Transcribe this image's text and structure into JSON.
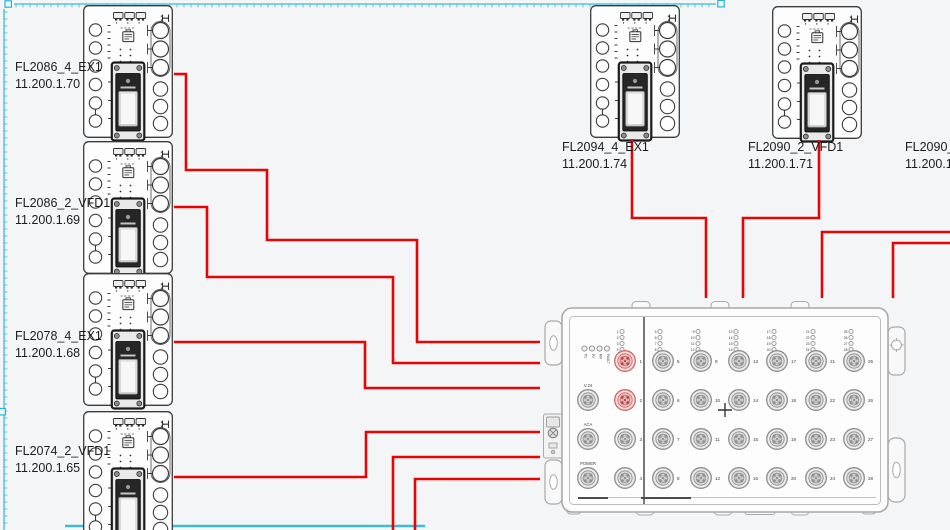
{
  "app": {
    "type": "network-topology-canvas"
  },
  "colors": {
    "background": "#f4f5f6",
    "connection": "#e60505",
    "guide": "#3bbdd8",
    "handle_fill": "#eafbfe",
    "device_stroke": "#3b3b3b",
    "switch_stroke": "#a6a6a6",
    "port_active_ring": "#cc6666",
    "port_idle_ring": "#8d8d8d",
    "label_text": "#1d1d1d"
  },
  "devices": {
    "left": [
      {
        "name": "FL2086_4_EX1",
        "ip": "11.200.1.70"
      },
      {
        "name": "FL2086_2_VFD1",
        "ip": "11.200.1.69"
      },
      {
        "name": "FL2078_4_EX1",
        "ip": "11.200.1.68"
      },
      {
        "name": "FL2074_2_VFD1",
        "ip": "11.200.1.65"
      }
    ],
    "top": [
      {
        "name": "FL2094_4_EX1",
        "ip": "11.200.1.74"
      },
      {
        "name": "FL2090_2_VFD1",
        "ip": "11.200.1.71"
      },
      {
        "name": "FL2090_4",
        "ip": "11.200.1."
      }
    ]
  },
  "switch": {
    "status_leds": [
      "P1",
      "P2",
      "RM",
      "FAULT"
    ],
    "aux_ports": [
      "V.24",
      "ACA",
      "POWER"
    ],
    "left_ports": [
      1,
      2,
      3,
      4
    ],
    "port_columns": [
      [
        5,
        6,
        7,
        8
      ],
      [
        9,
        10,
        11,
        12
      ],
      [
        13,
        14,
        15,
        16
      ],
      [
        17,
        18,
        19,
        20
      ],
      [
        21,
        22,
        23,
        24
      ],
      [
        25,
        26,
        27,
        28
      ]
    ],
    "active_ports": [
      1,
      2
    ]
  },
  "connections": [
    {
      "points": [
        [
          174,
          74
        ],
        [
          186,
          74
        ],
        [
          186,
          170
        ],
        [
          267,
          170
        ],
        [
          267,
          240
        ],
        [
          417,
          240
        ],
        [
          417,
          342
        ],
        [
          540,
          342
        ]
      ]
    },
    {
      "points": [
        [
          174,
          207
        ],
        [
          207,
          207
        ],
        [
          207,
          277
        ],
        [
          393,
          277
        ],
        [
          393,
          363
        ],
        [
          540,
          363
        ]
      ]
    },
    {
      "points": [
        [
          174,
          342
        ],
        [
          365,
          342
        ],
        [
          365,
          388
        ],
        [
          540,
          388
        ]
      ]
    },
    {
      "points": [
        [
          174,
          477
        ],
        [
          366,
          477
        ],
        [
          366,
          432
        ],
        [
          540,
          432
        ]
      ]
    },
    {
      "points": [
        [
          393,
          531
        ],
        [
          393,
          457
        ],
        [
          540,
          457
        ]
      ]
    },
    {
      "points": [
        [
          415,
          531
        ],
        [
          415,
          479
        ],
        [
          540,
          479
        ]
      ]
    },
    {
      "points": [
        [
          632,
          139
        ],
        [
          632,
          218
        ],
        [
          706,
          218
        ],
        [
          706,
          298
        ]
      ]
    },
    {
      "points": [
        [
          819,
          140
        ],
        [
          819,
          218
        ],
        [
          743,
          218
        ],
        [
          743,
          298
        ]
      ]
    },
    {
      "points": [
        [
          951,
          232
        ],
        [
          822,
          232
        ],
        [
          822,
          298
        ]
      ]
    },
    {
      "points": [
        [
          951,
          243
        ],
        [
          893,
          243
        ],
        [
          893,
          298
        ]
      ]
    }
  ]
}
